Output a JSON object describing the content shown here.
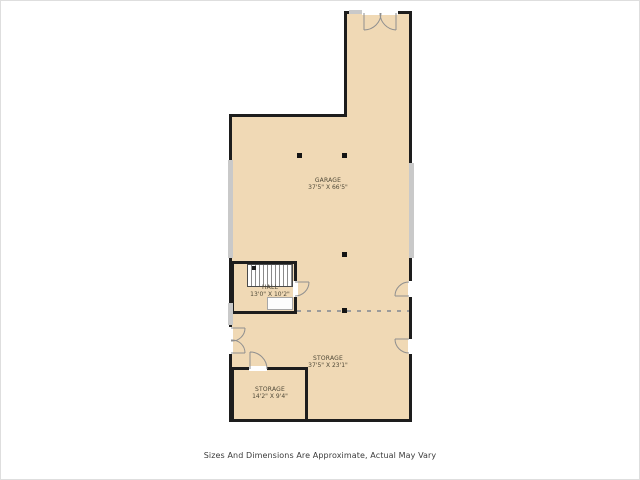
{
  "page": {
    "disclaimer": "Sizes And Dimensions Are Approximate, Actual May Vary"
  },
  "rooms": [
    {
      "id": "garage",
      "name": "GARAGE",
      "dims": "37'5\" X 66'5\""
    },
    {
      "id": "hall",
      "name": "HALL",
      "dims": "13'0\" X 10'2\""
    },
    {
      "id": "storage-main",
      "name": "STORAGE",
      "dims": "37'5\" X 23'1\""
    },
    {
      "id": "storage-small",
      "name": "STORAGE",
      "dims": "14'2\" X 9'4\""
    }
  ],
  "colors": {
    "floor": "#f0d9b5",
    "wall": "#1d1d1d",
    "window_band": "#c9c9c9",
    "door_arc": "#8f8f8f",
    "background": "#ffffff"
  }
}
